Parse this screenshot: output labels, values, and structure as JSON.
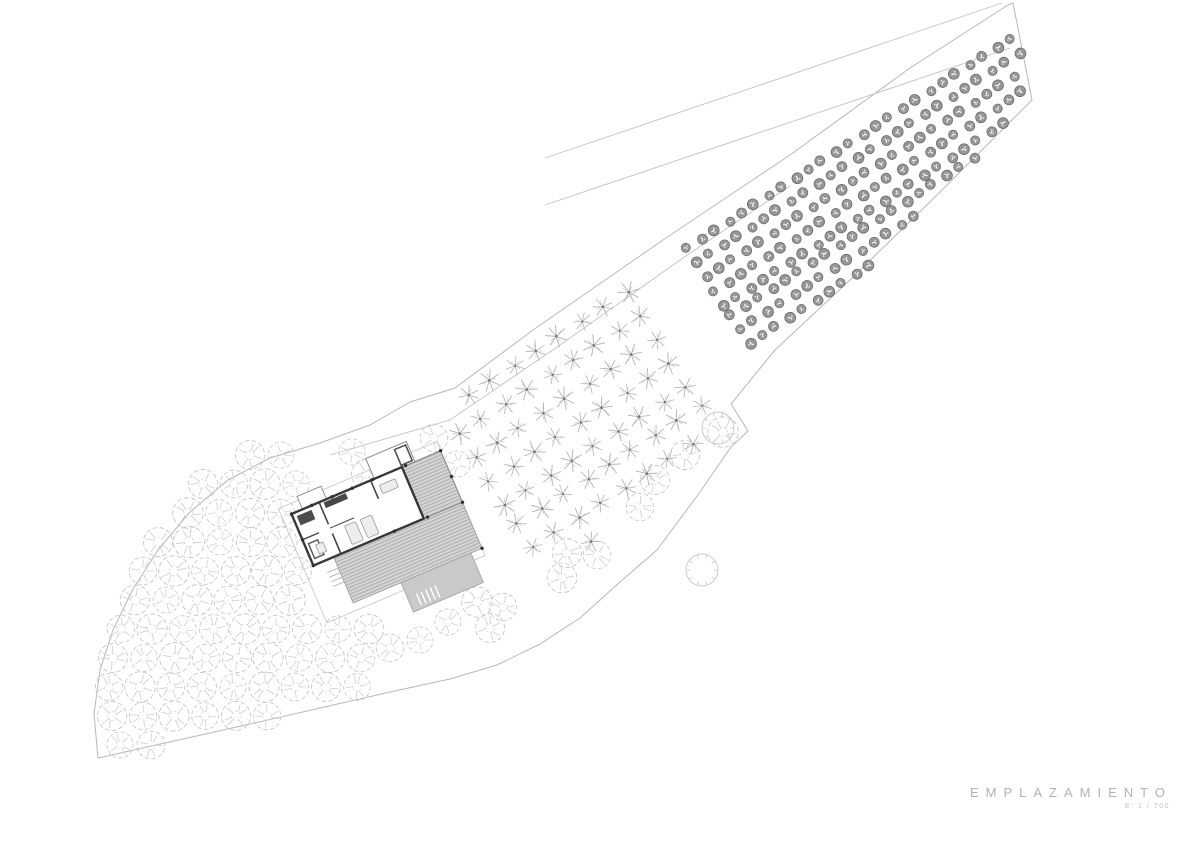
{
  "title_block": {
    "title": "EMPLAZAMIENTO",
    "scale_label": "E: 1 / 700"
  },
  "colors": {
    "background": "#ffffff",
    "boundary": "#b7b7b7",
    "inner_line": "#c2c2c2",
    "scalloped_tree": "#c6c6c6",
    "star_tree": "#b5b5b5",
    "star_center": "#7a7a7a",
    "dark_tree_fill": "#979797",
    "dark_tree_edge": "#6d6d6d",
    "wall": "#383838",
    "deck_hatch": "#a8a8a8",
    "platform": "#c3c3c3"
  },
  "site": {
    "outline_path": "M 98,758 L 250,724 L 390,692 L 450,679 L 497,665 L 540,644 L 580,618 L 620,582 L 657,550 L 700,492 L 731,447 L 748,431 L 731,404 L 775,350 L 850,280 L 940,192 L 1032,100 L 1013,3 L 1008,5 L 910,68 L 790,155 L 663,240 L 533,330 L 455,388 L 410,402 L 370,425 L 320,443 L 270,458 L 228,480 L 190,512 L 158,550 L 133,589 L 113,630 L 100,670 L 94,714 Z",
    "inner_line_path": "M 330,455 L 450,420 L 560,345 L 683,258 L 790,186",
    "road_outer_path": "M 545,158 L 1002,3",
    "road_inner_path": "M 545,205 L 1010,48",
    "plain_trees": [
      [
        718,
        428
      ],
      [
        702,
        570
      ]
    ],
    "scalloped_trees": [
      [
        250,
        455,
        1
      ],
      [
        281,
        455,
        0.9
      ],
      [
        203,
        484,
        1
      ],
      [
        234,
        484,
        0.95
      ],
      [
        265,
        484,
        1.05
      ],
      [
        296,
        484,
        0.9
      ],
      [
        188,
        513,
        1.05
      ],
      [
        219,
        513,
        0.92
      ],
      [
        250,
        513,
        1
      ],
      [
        281,
        513,
        0.95
      ],
      [
        158,
        542,
        1
      ],
      [
        189,
        542,
        1.08
      ],
      [
        220,
        542,
        0.9
      ],
      [
        251,
        542,
        1
      ],
      [
        282,
        542,
        1.04
      ],
      [
        143,
        571,
        0.95
      ],
      [
        174,
        571,
        1.05
      ],
      [
        205,
        571,
        0.92
      ],
      [
        236,
        571,
        1
      ],
      [
        267,
        571,
        1.06
      ],
      [
        298,
        571,
        0.94
      ],
      [
        135,
        600,
        1.02
      ],
      [
        166,
        600,
        0.9
      ],
      [
        197,
        600,
        1.05
      ],
      [
        228,
        600,
        0.96
      ],
      [
        259,
        600,
        1
      ],
      [
        290,
        600,
        1.05
      ],
      [
        121,
        629,
        0.95
      ],
      [
        152,
        629,
        1.04
      ],
      [
        183,
        629,
        0.92
      ],
      [
        214,
        629,
        1
      ],
      [
        245,
        629,
        1.05
      ],
      [
        276,
        629,
        0.94
      ],
      [
        307,
        629,
        1
      ],
      [
        338,
        629,
        0.9
      ],
      [
        369,
        629,
        1.02
      ],
      [
        113,
        658,
        1
      ],
      [
        144,
        658,
        0.92
      ],
      [
        175,
        658,
        1.06
      ],
      [
        206,
        658,
        0.95
      ],
      [
        237,
        658,
        1
      ],
      [
        268,
        658,
        1.04
      ],
      [
        299,
        658,
        0.92
      ],
      [
        330,
        658,
        1
      ],
      [
        361,
        658,
        0.95
      ],
      [
        109,
        687,
        0.94
      ],
      [
        140,
        687,
        1.05
      ],
      [
        171,
        687,
        0.95
      ],
      [
        202,
        687,
        1
      ],
      [
        233,
        687,
        0.9
      ],
      [
        264,
        687,
        1.04
      ],
      [
        295,
        687,
        0.96
      ],
      [
        326,
        687,
        1
      ],
      [
        357,
        687,
        0.92
      ],
      [
        112,
        716,
        1
      ],
      [
        143,
        716,
        0.94
      ],
      [
        174,
        716,
        1.04
      ],
      [
        205,
        716,
        0.92
      ],
      [
        236,
        716,
        1
      ],
      [
        267,
        716,
        0.95
      ],
      [
        120,
        745,
        0.9
      ],
      [
        151,
        745,
        0.96
      ],
      [
        366,
        474,
        1
      ],
      [
        352,
        452,
        0.9
      ],
      [
        434,
        438,
        0.95
      ],
      [
        457,
        464,
        0.9
      ],
      [
        477,
        602,
        1.05
      ],
      [
        503,
        607,
        0.95
      ],
      [
        490,
        628,
        1
      ],
      [
        448,
        622,
        0.9
      ],
      [
        567,
        553,
        1
      ],
      [
        597,
        555,
        0.95
      ],
      [
        562,
        578,
        1.02
      ],
      [
        390,
        648,
        0.95
      ],
      [
        420,
        640,
        0.9
      ],
      [
        723,
        432,
        1.05
      ],
      [
        685,
        455,
        1
      ],
      [
        655,
        480,
        1
      ],
      [
        640,
        507,
        0.95
      ]
    ],
    "orchard_zones": [
      {
        "name": "star-orchard",
        "symbol": "#tree-star",
        "origin": [
          445,
          412
        ],
        "u": [
          22.7,
          -14.7
        ],
        "v": [
          14.7,
          22.7
        ],
        "ni": 12,
        "nj": 8,
        "clips": [
          [
            -0.695,
            -1,
            -718
          ],
          [
            1,
            0.97,
            1125
          ],
          [
            1,
            1,
            1172
          ],
          [
            0.1,
            1,
            604
          ],
          [
            1,
            -0.68,
            451
          ]
        ]
      },
      {
        "name": "dark-orchard",
        "symbol": "#tree-dark",
        "origin": [
          688,
          250
        ],
        "u": [
          13.4,
          -8.7
        ],
        "v": [
          8.7,
          13.4
        ],
        "ni": 25,
        "nj": 8,
        "clips": [
          [
            1,
            0.97,
            1129
          ],
          [
            1,
            -0.18,
            1013
          ],
          [
            -0.72,
            -1,
            -700
          ],
          [
            -1,
            0.68,
            -441
          ]
        ]
      }
    ],
    "building": {
      "cx": 372,
      "cy": 545,
      "rotation": -23
    }
  }
}
